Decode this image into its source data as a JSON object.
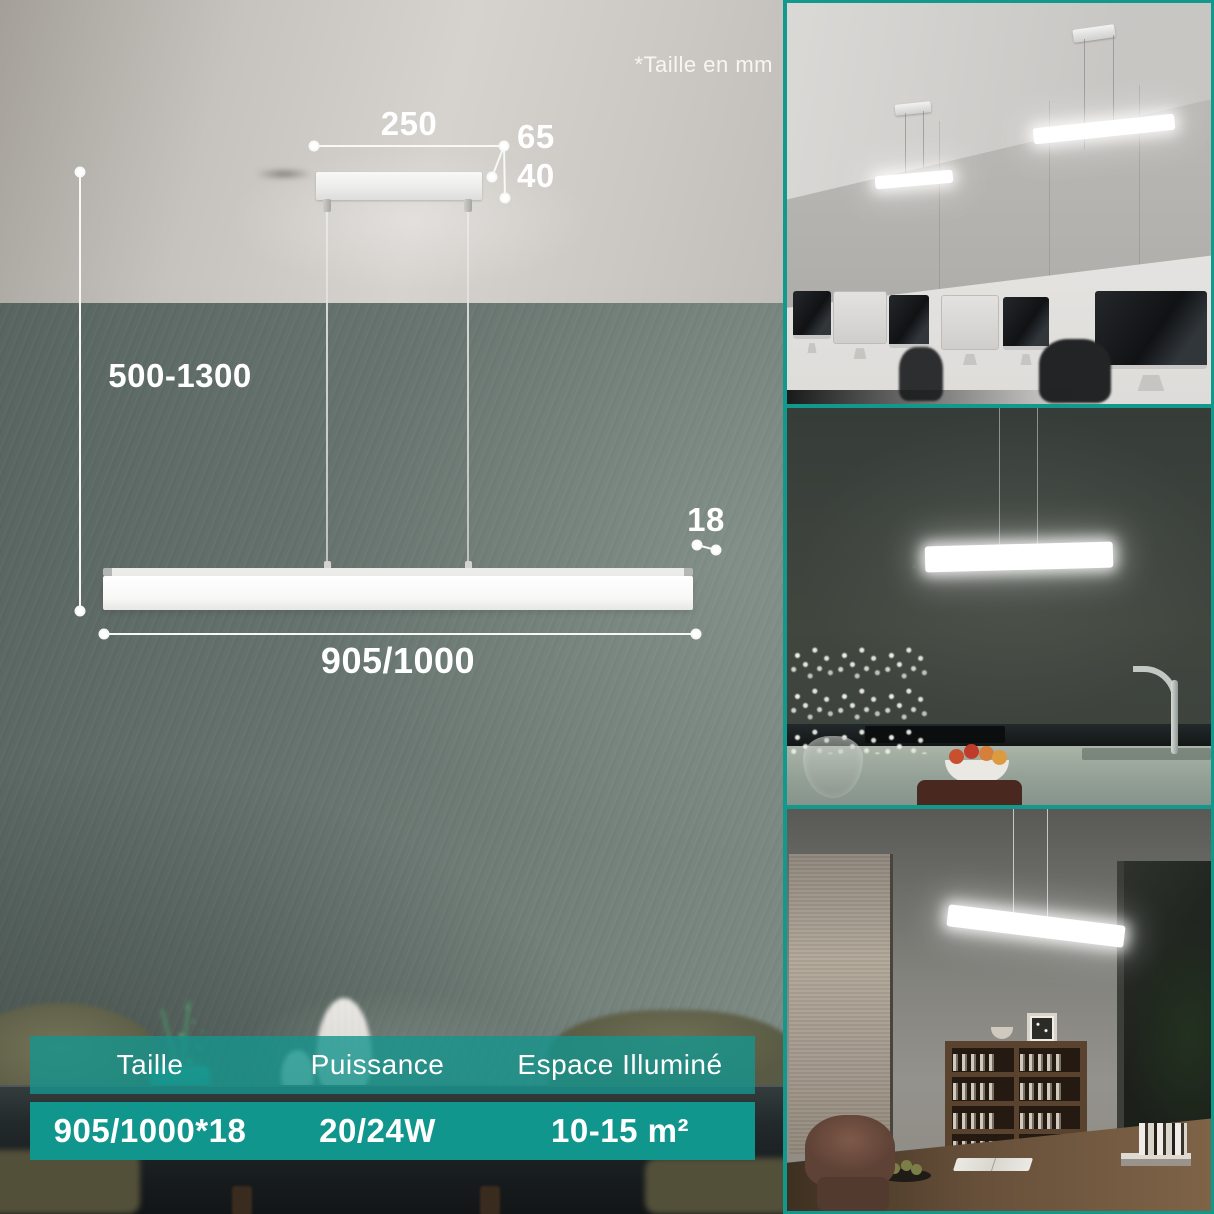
{
  "note": "*Taille en mm",
  "diagram": {
    "canopy_width_mm": "250",
    "canopy_depth_mm": "65",
    "canopy_height_mm": "40",
    "suspension_height_mm": "500-1300",
    "bar_length_mm": "905/1000",
    "bar_thickness_mm": "18"
  },
  "spec_table": {
    "columns": [
      {
        "label": "Taille",
        "value": "905/1000*18"
      },
      {
        "label": "Puissance",
        "value": "20/24W"
      },
      {
        "label": "Espace Illuminé",
        "value": "10-15 m²"
      }
    ]
  },
  "photos": [
    {
      "name": "office-scene",
      "description": "Two linear pendant lamps above a white office desk with iMac computers"
    },
    {
      "name": "kitchen-scene",
      "description": "Linear pendant lamp glowing over a dark kitchen counter with vase, fruit bowl and faucet"
    },
    {
      "name": "study-scene",
      "description": "Linear pendant lamp over a wooden desk with bookshelf, window and leather chair"
    }
  ],
  "colors": {
    "accent_teal": "#10968d",
    "frame_teal": "#12998e",
    "header_teal": "rgba(21,149,141,0.80)"
  }
}
